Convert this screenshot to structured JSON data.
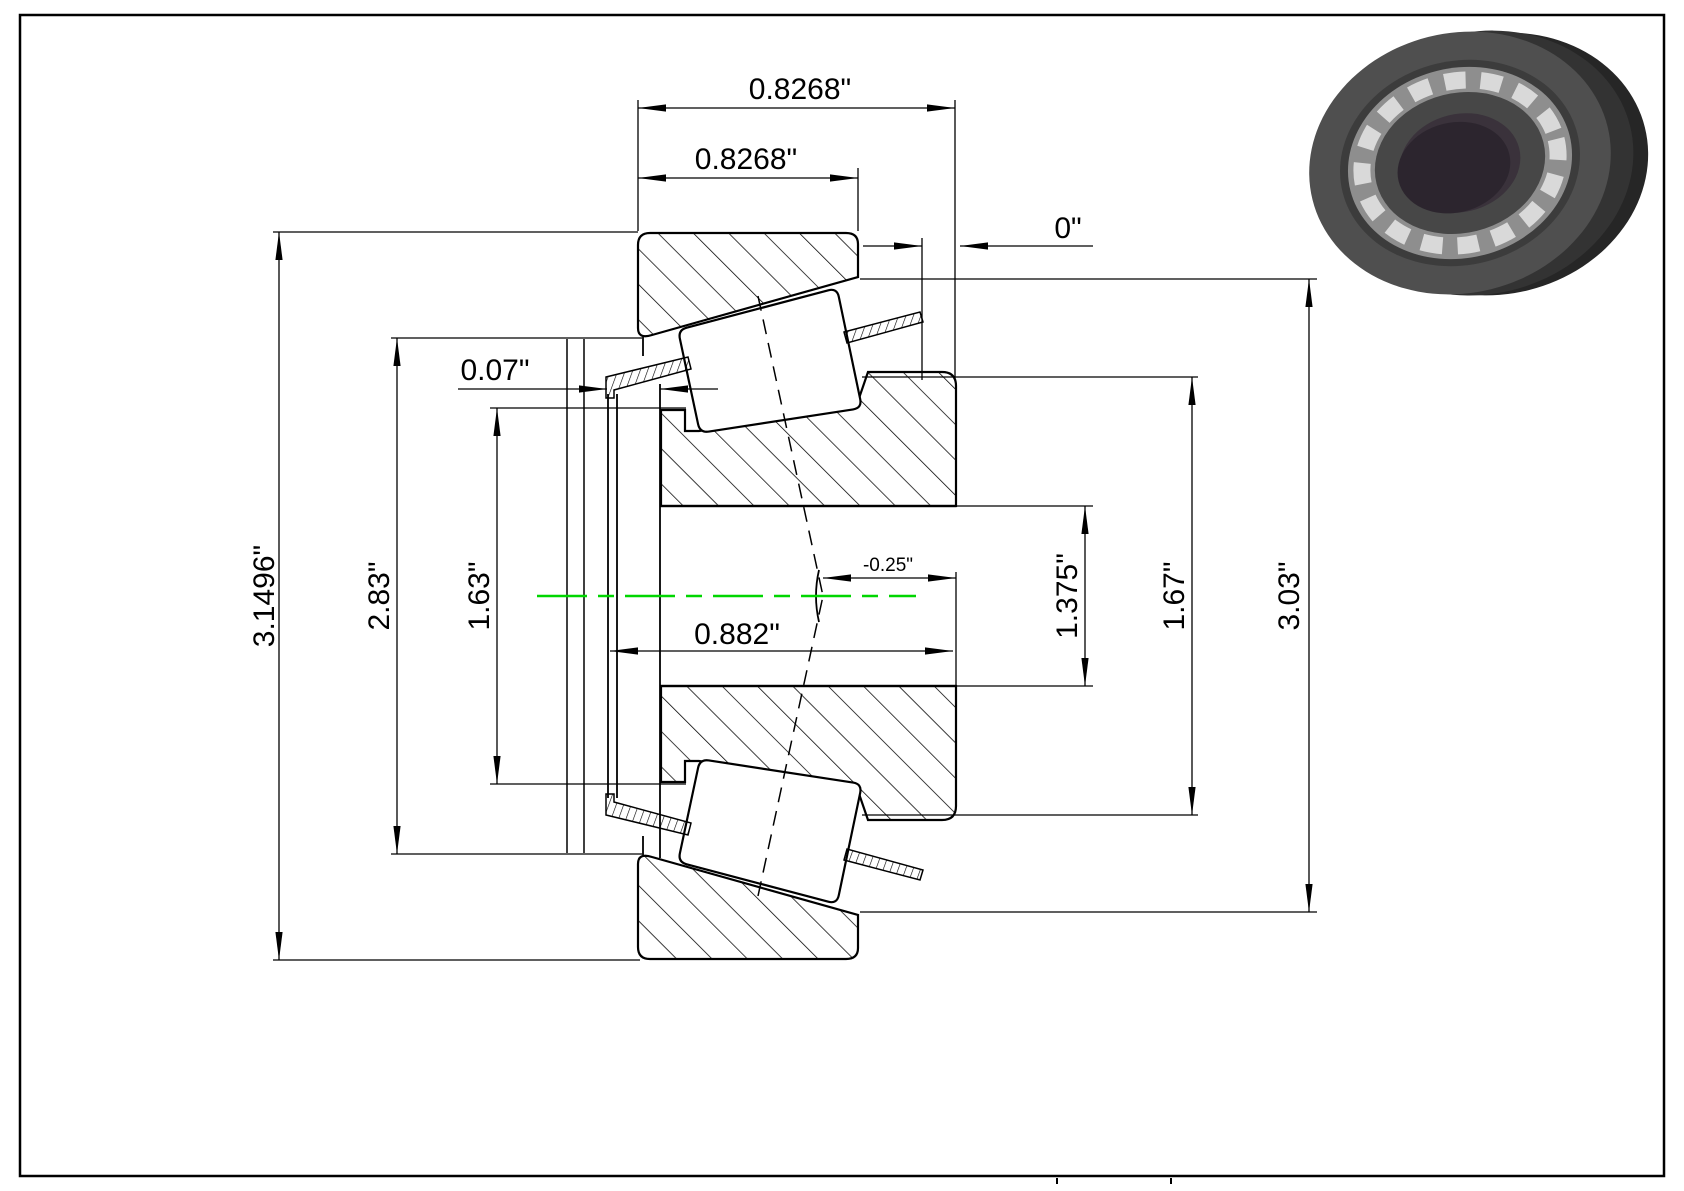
{
  "drawing": {
    "type": "tapered-roller-bearing-cross-section",
    "dims": {
      "overall_width": "0.8268\"",
      "cup_width": "0.8268\"",
      "standout": "0\"",
      "cage_clearance": "0.07\"",
      "cup_od": "3.1496\"",
      "cup_race_small_d": "2.83\"",
      "cage_small_d": "1.63\"",
      "cone_width": "0.882\"",
      "eff_load_center": "-0.25\"",
      "bore_d": "1.375\"",
      "cone_rib_d": "1.67\"",
      "cup_race_large_d": "3.03\""
    },
    "colors": {
      "centerline": "#00d600",
      "line": "#000000",
      "background": "#ffffff"
    }
  }
}
